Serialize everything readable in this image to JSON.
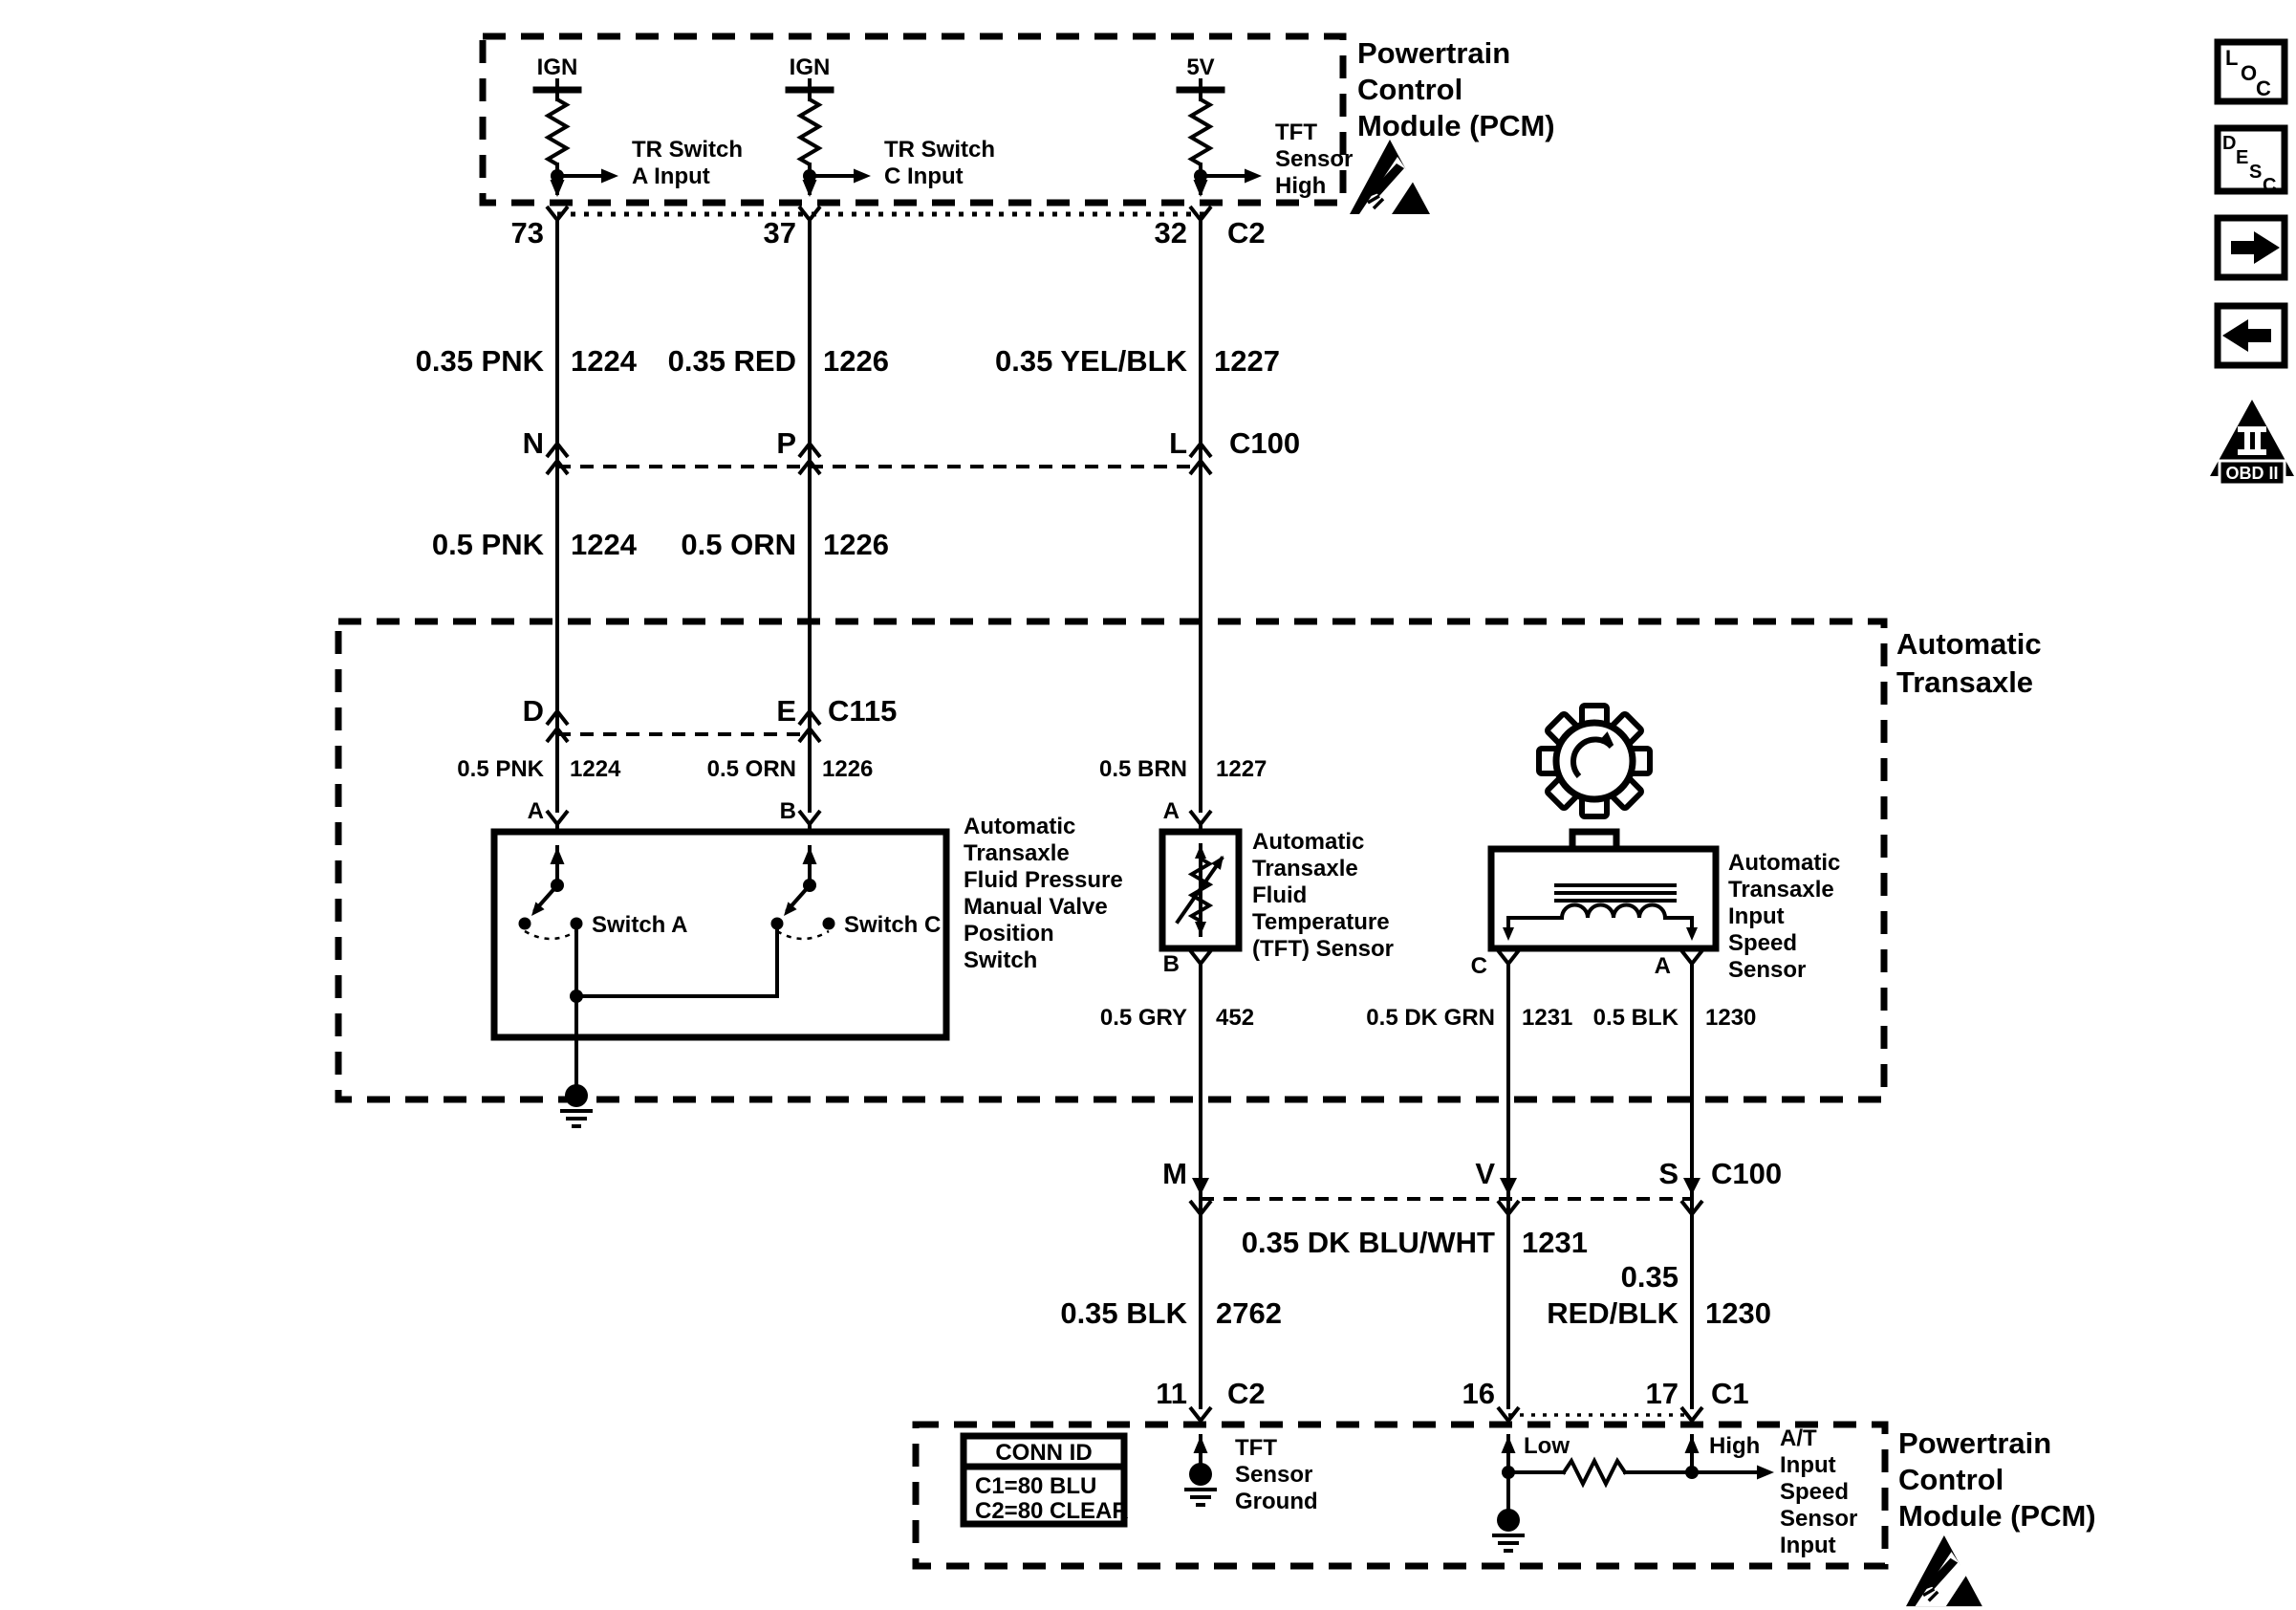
{
  "colors": {
    "ink": "#000000",
    "paper": "#ffffff"
  },
  "pcm_top": {
    "name_lines": [
      "Powertrain",
      "Control",
      "Module (PCM)"
    ],
    "cols": [
      {
        "supply": "IGN",
        "pin": "73",
        "sig": [
          "TR Switch",
          "A Input"
        ]
      },
      {
        "supply": "IGN",
        "pin": "37",
        "sig": [
          "TR Switch",
          "C Input"
        ]
      },
      {
        "supply": "5V",
        "pin": "32",
        "conn": "C2",
        "sig": [
          "TFT",
          "Sensor",
          "High"
        ]
      }
    ]
  },
  "harness_upper": {
    "wires": [
      [
        "0.35 PNK",
        "1224"
      ],
      [
        "0.35 RED",
        "1226"
      ],
      [
        "0.35 YEL/BLK",
        "1227"
      ]
    ],
    "c100": {
      "pins": [
        "N",
        "P",
        "L"
      ],
      "label": "C100"
    },
    "wires2": [
      [
        "0.5 PNK",
        "1224"
      ],
      [
        "0.5 ORN",
        "1226"
      ]
    ]
  },
  "transaxle": {
    "name_lines": [
      "Automatic",
      "Transaxle"
    ],
    "c115": {
      "pins": [
        "D",
        "E"
      ],
      "label": "C115"
    },
    "wires": [
      [
        "0.5 PNK",
        "1224"
      ],
      [
        "0.5 ORN",
        "1226"
      ]
    ],
    "pressure_switch": {
      "pin_a": "A",
      "pin_b": "B",
      "switch_a": "Switch A",
      "switch_c": "Switch C",
      "label_lines": [
        "Automatic",
        "Transaxle",
        "Fluid Pressure",
        "Manual Valve",
        "Position",
        "Switch"
      ]
    },
    "tft_sensor": {
      "wire": [
        "0.5 BRN",
        "1227"
      ],
      "pin_top": "A",
      "pin_bottom": "B",
      "label_lines": [
        "Automatic",
        "Transaxle",
        "Fluid",
        "Temperature",
        "(TFT) Sensor"
      ]
    },
    "speed_sensor": {
      "pin_left": "C",
      "pin_right": "A",
      "label_lines": [
        "Automatic",
        "Transaxle",
        "Input",
        "Speed",
        "Sensor"
      ]
    },
    "wires_lower": [
      [
        "0.5 GRY",
        "452"
      ],
      [
        "0.5 DK GRN",
        "1231"
      ],
      [
        "0.5 BLK",
        "1230"
      ]
    ]
  },
  "harness_lower": {
    "c100": {
      "pins": [
        "M",
        "V",
        "S"
      ],
      "label": "C100"
    },
    "wire_blu": [
      "0.35 DK BLU/WHT",
      "1231"
    ],
    "wire_red": [
      "0.35",
      "RED/BLK",
      "1230"
    ],
    "wire_blk": [
      "0.35 BLK",
      "2762"
    ]
  },
  "pcm_bottom": {
    "pins": [
      {
        "num": "11",
        "conn": "C2"
      },
      {
        "num": "16"
      },
      {
        "num": "17",
        "conn": "C1"
      }
    ],
    "conn_table": {
      "header": "CONN ID",
      "rows": [
        "C1=80 BLU",
        "C2=80 CLEAR"
      ]
    },
    "tft_ground_lines": [
      "TFT",
      "Sensor",
      "Ground"
    ],
    "low": "Low",
    "high": "High",
    "speed_input_lines": [
      "A/T",
      "Input",
      "Speed",
      "Sensor",
      "Input"
    ],
    "name_lines": [
      "Powertrain",
      "Control",
      "Module (PCM)"
    ]
  },
  "side_icons": {
    "loc_letters": [
      "L",
      "O",
      "C"
    ],
    "desc_letters": [
      "D",
      "E",
      "S",
      "C"
    ],
    "obd": {
      "numeral": "II",
      "label": "OBD II"
    }
  }
}
